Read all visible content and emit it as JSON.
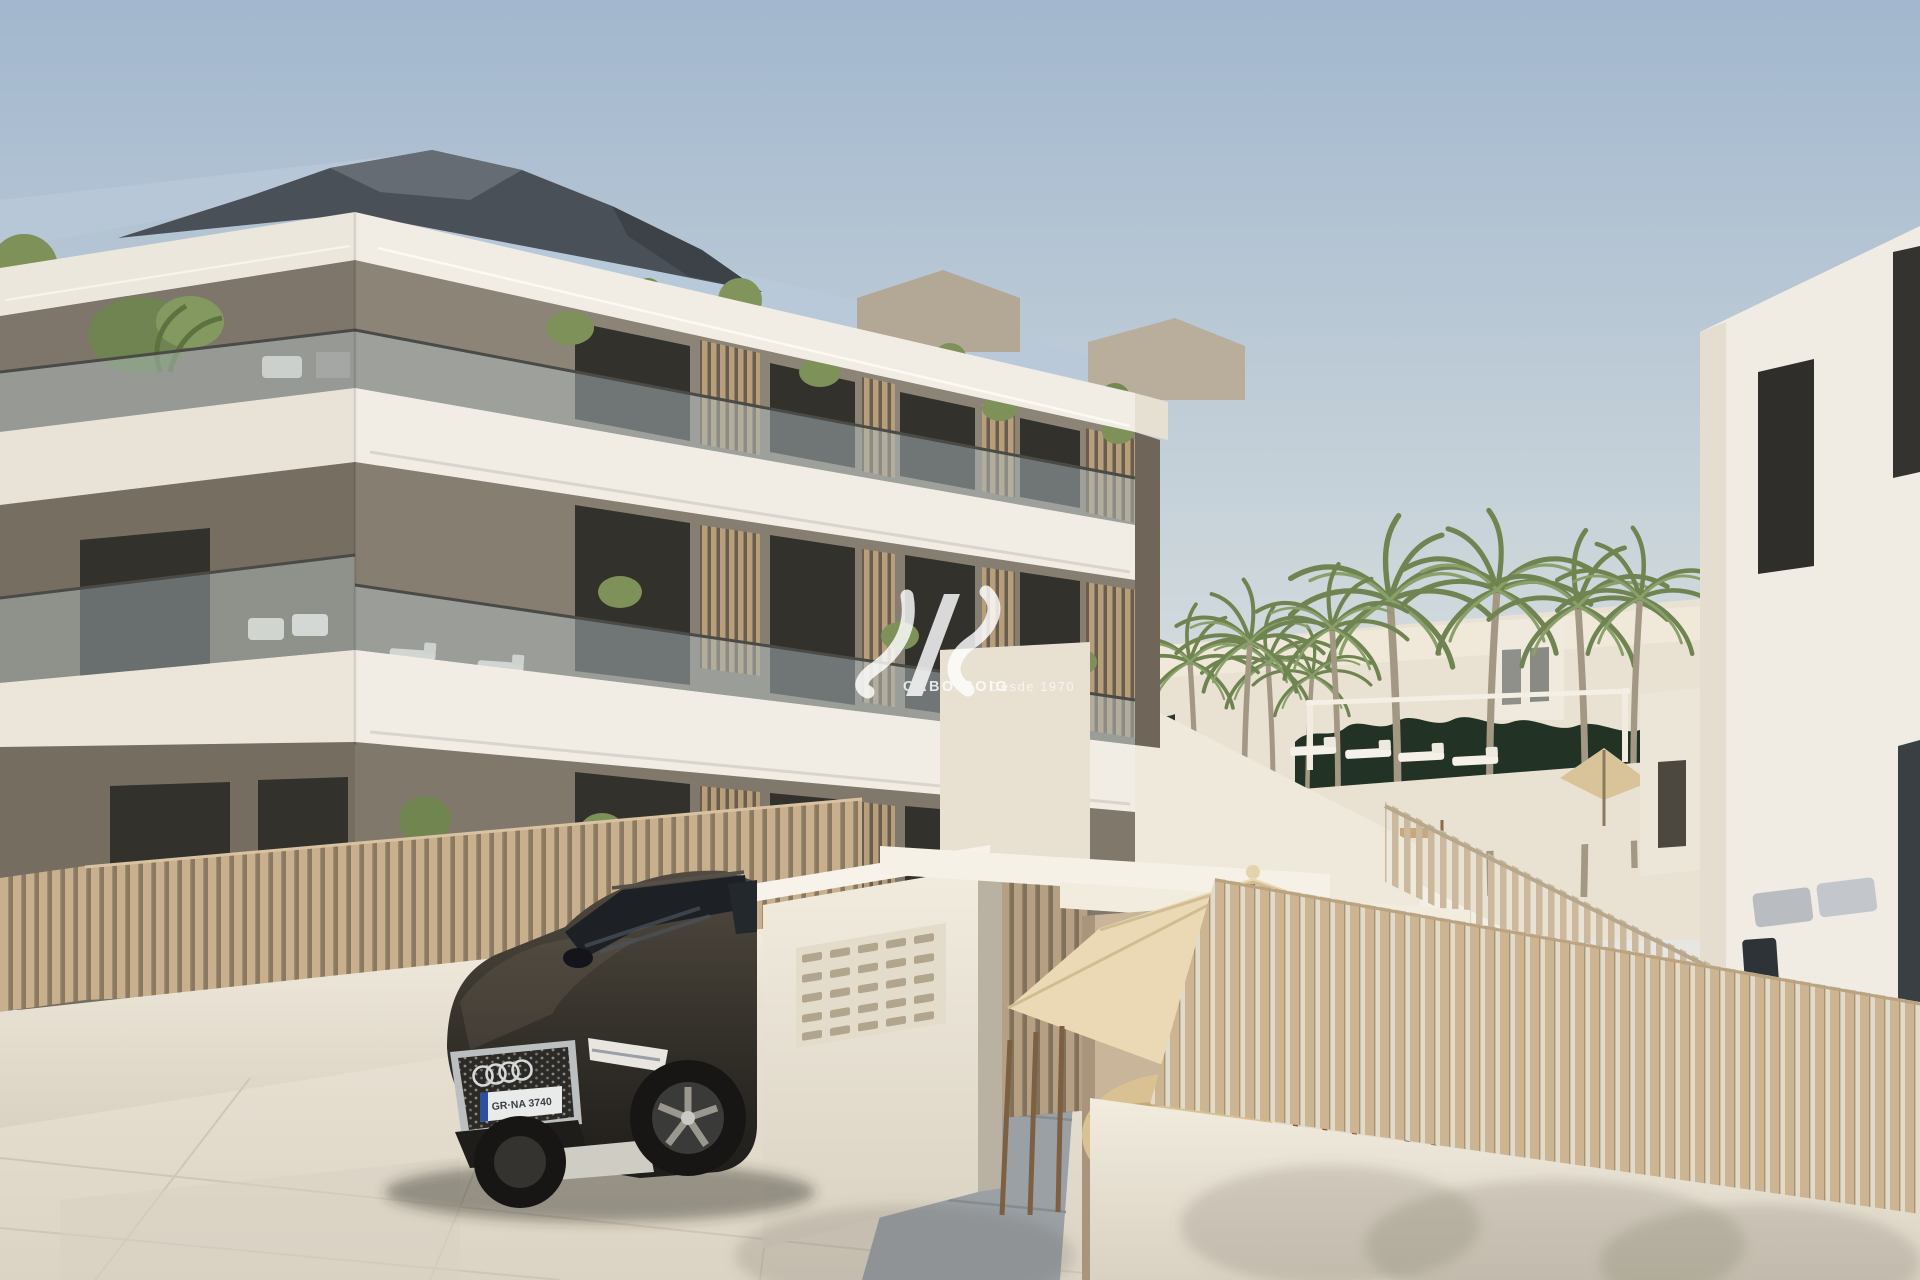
{
  "scene": {
    "type": "architectural-render",
    "description": "Daylight exterior render of a new-build three-storey apartment complex with white slab balconies, taupe walls, wooden slat screens and fences, palm-lined pool terrace, exterior staircase, entrance gate with mailbox wall, cream parasols and a dark SUV parked in front"
  },
  "watermark": {
    "brand": "CABO ROIG",
    "tagline": "Desde 1970",
    "logo": "siv-monogram"
  },
  "vehicle": {
    "make_icon": "audi-rings",
    "license_plate": "GR·NA 3740"
  },
  "palette": {
    "sky_top": "#a2b7ce",
    "sky_horizon": "#ece9e2",
    "facade_white": "#f2ede4",
    "facade_shade": "#ded7ca",
    "wall_taupe": "#8d8478",
    "wall_taupe_dark": "#6f6659",
    "window_dark": "#32312c",
    "slat_wood": "#c8af8e",
    "slat_gap": "#82705a",
    "glass_rail": "#aebcbe",
    "roof_dark": "#4a5057",
    "roof_glass": "#b7c7d8",
    "palm_green": "#7d9159",
    "hedge_green": "#223326",
    "umbrella_cream": "#ead9b4",
    "pavement": "#e4ddd0",
    "car_body": "#38332c"
  }
}
